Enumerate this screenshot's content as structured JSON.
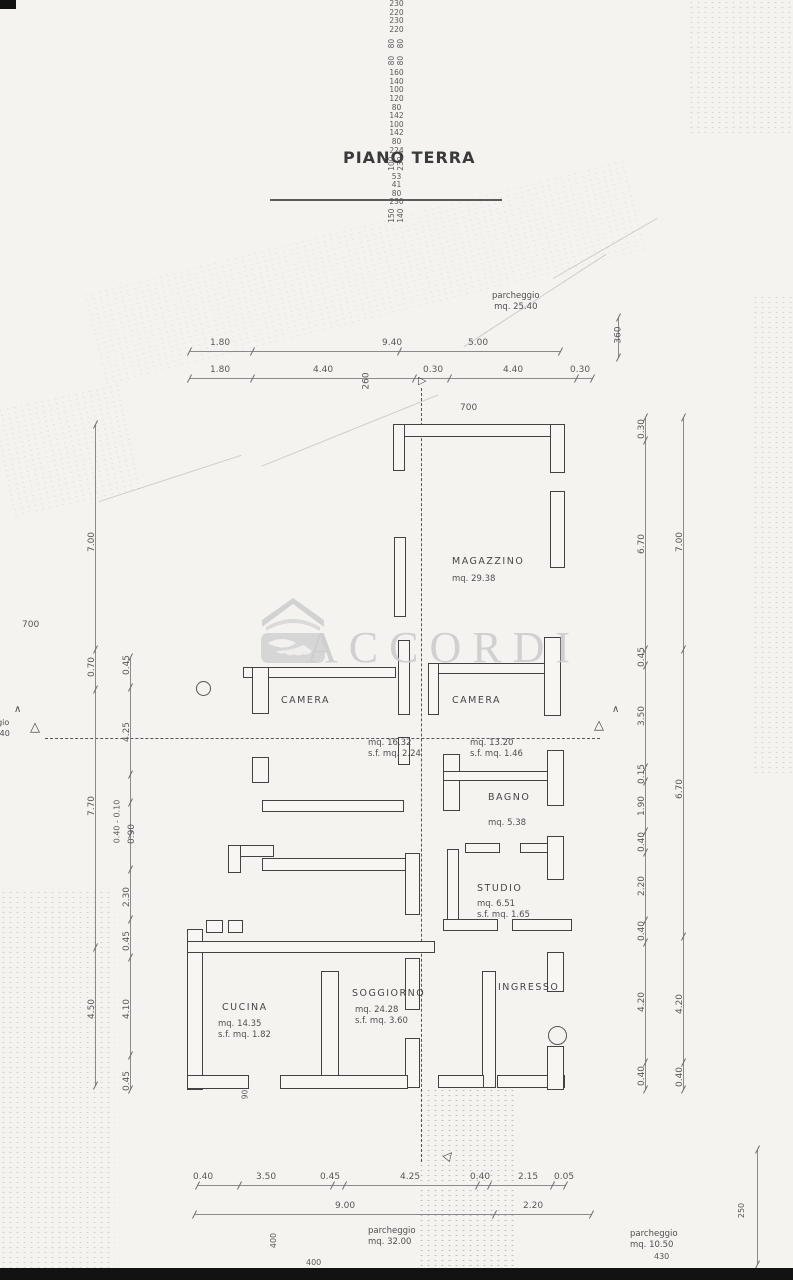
{
  "page": {
    "title": "PIANO TERRA"
  },
  "watermark": {
    "brand": "ACCORDI"
  },
  "parking": {
    "top": {
      "line1": "parcheggio",
      "line2": "mq. 25.40"
    },
    "bottom_center": {
      "line1": "parcheggio",
      "line2": "mq. 32.00"
    },
    "bottom_right": {
      "line1": "parcheggio",
      "line2": "mq. 10.50"
    }
  },
  "rooms": {
    "magazzino": {
      "name": "MAGAZZINO",
      "area": "mq. 29.38"
    },
    "camera_left": {
      "name": "CAMERA",
      "area": "mq. 16.32",
      "surface": "s.f. mq. 2.24"
    },
    "camera_right": {
      "name": "CAMERA",
      "area": "mq. 13.20",
      "surface": "s.f. mq. 1.46"
    },
    "bagno": {
      "name": "BAGNO",
      "area": "mq. 5.38"
    },
    "studio": {
      "name": "STUDIO",
      "area": "mq. 6.51",
      "surface": "s.f. mq. 1.65"
    },
    "cucina": {
      "name": "CUCINA",
      "area": "mq. 14.35",
      "surface": "s.f. mq. 1.82"
    },
    "soggiorno": {
      "name": "SOGGIORNO",
      "area": "mq. 24.28",
      "surface": "s.f. mq. 3.60"
    },
    "ingresso": {
      "name": "INGRESSO"
    }
  },
  "dimensions": {
    "top_row1": [
      "1.80",
      "9.40",
      "5.00"
    ],
    "top_row2": [
      "1.80",
      "4.40",
      "0.30",
      "4.40",
      "0.30"
    ],
    "bottom_row1": [
      "0.40",
      "3.50",
      "0.45",
      "4.25",
      "0.40",
      "2.15",
      "0.05"
    ],
    "bottom_row2": [
      "9.00",
      "2.20"
    ],
    "left_outer": [
      "7.00",
      "0.70",
      "7.70",
      "4.50"
    ],
    "left_inner": [
      "0.45",
      "4.25",
      "0.40 - 0.10",
      "0.90",
      "2.30",
      "0.45",
      "4.10",
      "0.45"
    ],
    "right_inner": [
      "0.30",
      "6.70",
      "0.45",
      "3.50",
      "0.15",
      "1.90",
      "0.40",
      "2.20",
      "0.40",
      "4.20",
      "0.40"
    ],
    "right_outer": [
      "7.00",
      "6.70",
      "4.20",
      "0.40"
    ]
  },
  "labels": {
    "mag_700": "700",
    "left_700": "700",
    "v360": "360",
    "v260": "260",
    "v90": "90",
    "v400": "400",
    "b400": "400",
    "b430": "430",
    "v250": "250"
  },
  "openings": {
    "left_230_220": [
      "230",
      "220"
    ],
    "right_230_220": [
      "230",
      "220"
    ],
    "right_80_80": [
      "80",
      "80"
    ],
    "mid_80_80": [
      "80",
      "80"
    ],
    "s160_140": [
      "160",
      "140"
    ],
    "s100_120": [
      "100",
      "120"
    ],
    "s80_142": [
      "80",
      "142"
    ],
    "s100_142": [
      "100",
      "142"
    ],
    "s80_224": [
      "80",
      "224"
    ],
    "s100_230": [
      "100",
      "230"
    ],
    "s53_41": [
      "53",
      "41"
    ],
    "s80_230": [
      "80",
      "230"
    ],
    "s150_140": [
      "150",
      "140"
    ]
  },
  "edge_partial": {
    "line1": "ggio",
    "line2": "0,40"
  },
  "markers": {
    "triangle": "△",
    "caret": "∧",
    "arrow": "▷"
  },
  "colors": {
    "ink": "#4a4a4a",
    "paper": "#f4f3f0",
    "watermark": "#cdcdcd"
  }
}
